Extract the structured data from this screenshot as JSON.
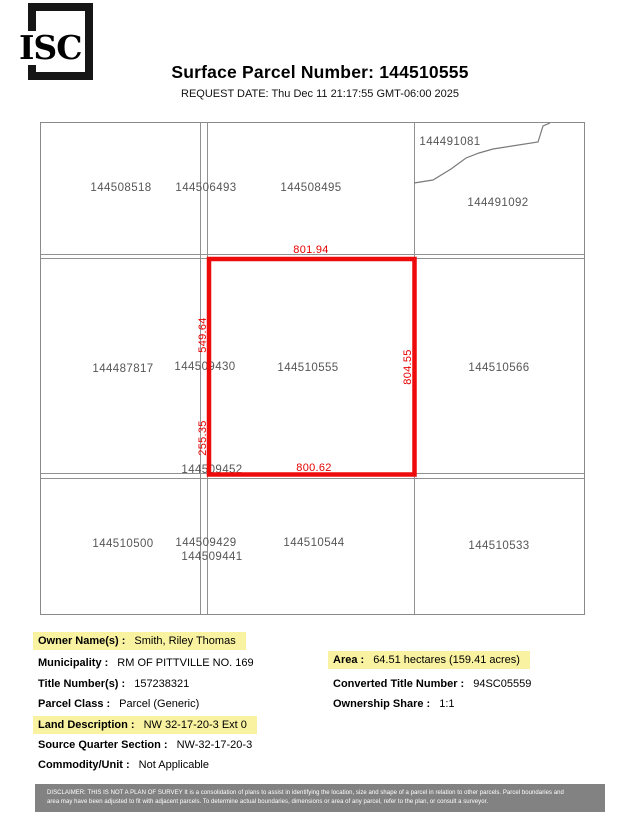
{
  "header": {
    "logo_text": "ISC",
    "title": "Surface Parcel Number: 144510555",
    "request_date": "REQUEST DATE: Thu Dec 11 21:17:55 GMT-06:00 2025"
  },
  "map": {
    "selected_parcel": "144510555",
    "outline_color": "#ee0b0b",
    "dimension_text_color": "#e60000",
    "parcel_label_color": "#565656",
    "highlight_color": "#f9f3a1",
    "parcels": [
      "144508518",
      "144506493",
      "144508495",
      "144491081",
      "144491092",
      "144487817",
      "144509430",
      "144510555",
      "144510566",
      "144509452",
      "144510500",
      "144509429",
      "144509441",
      "144510544",
      "144510533"
    ],
    "dimensions": {
      "top": "801.94",
      "bottom": "800.62",
      "left_upper": "549.64",
      "left_lower": "255.35",
      "right": "804.55"
    }
  },
  "details": {
    "left": [
      {
        "label": "Owner Name(s) :",
        "value": "Smith, Riley Thomas",
        "highlighted": true
      },
      {
        "label": "Municipality :",
        "value": "RM OF PITTVILLE NO. 169",
        "highlighted": false
      },
      {
        "label": "Title Number(s) :",
        "value": "157238321",
        "highlighted": false
      },
      {
        "label": "Parcel Class :",
        "value": "Parcel (Generic)",
        "highlighted": false
      },
      {
        "label": "Land Description :",
        "value": "NW  32-17-20-3 Ext 0",
        "highlighted": true
      },
      {
        "label": "Source Quarter Section :",
        "value": "NW-32-17-20-3",
        "highlighted": false
      },
      {
        "label": "Commodity/Unit :",
        "value": "Not Applicable",
        "highlighted": false
      }
    ],
    "right": [
      {
        "label": "Area :",
        "value": "64.51 hectares (159.41 acres)",
        "highlighted": true
      },
      {
        "label": "Converted Title Number :",
        "value": "94SC05559",
        "highlighted": false
      },
      {
        "label": "Ownership Share :",
        "value": "1:1",
        "highlighted": false
      }
    ]
  },
  "disclaimer": {
    "line1": "DISCLAIMER: THIS IS NOT A PLAN OF SURVEY It is a consolidation of plans to assist in identifying the location, size and shape of a parcel in relation to other parcels.  Parcel boundaries and",
    "line2": "area may have been adjusted to fit with adjacent parcels. To determine actual boundaries, dimensions or area of any parcel, refer to the plan, or consult a surveyor."
  }
}
